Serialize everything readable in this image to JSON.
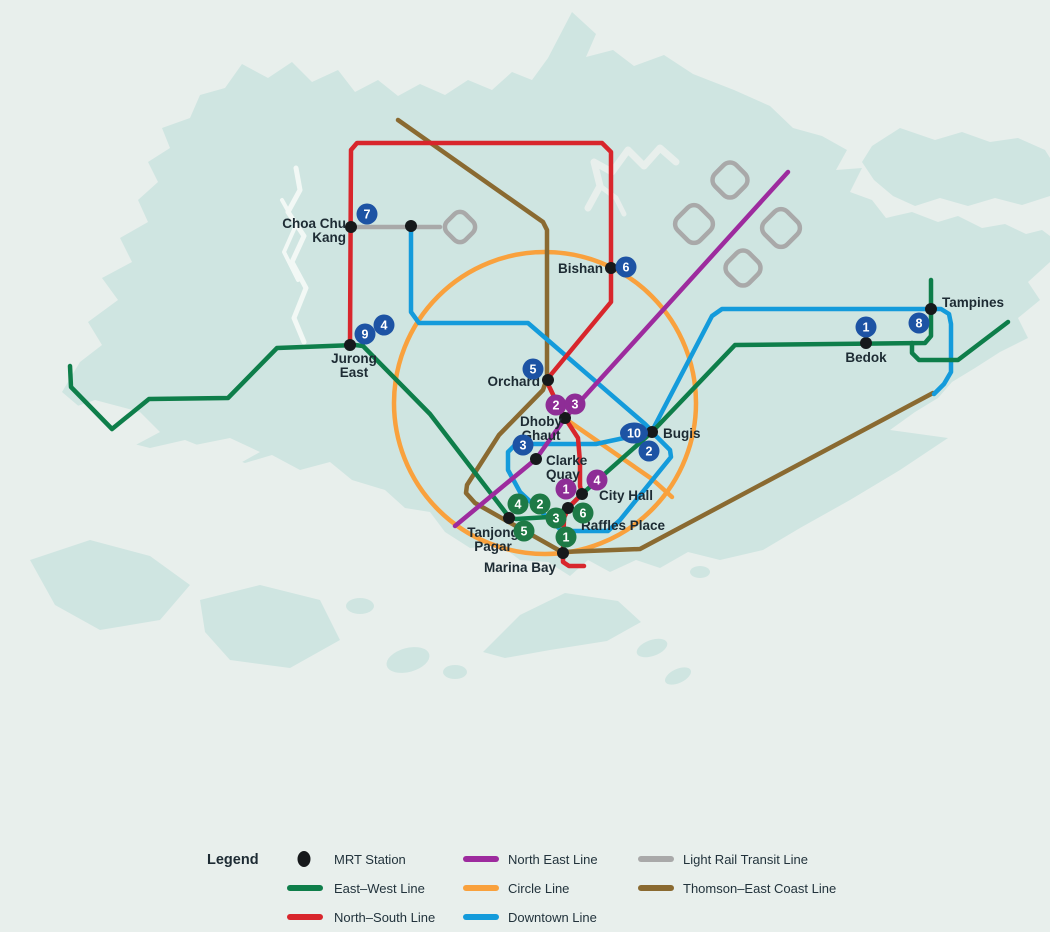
{
  "title": "Singapore MRT map",
  "colors": {
    "sea": "#e8efec",
    "island": "#cfe5e1",
    "island_soft": "#d8eae6",
    "water_detail": "#f2f8f5",
    "east_west": "#0e7e4a",
    "north_south": "#d8262c",
    "north_east": "#9d2b9e",
    "circle": "#f9a13d",
    "downtown": "#149bdb",
    "lrt": "#a9a9a9",
    "thomson": "#8a6a31",
    "badge_blue": "#1d53a4",
    "badge_purple": "#8e2d96",
    "badge_green": "#1e7a46",
    "station_dot": "#16191b",
    "label": "#1d2b33"
  },
  "stations": {
    "choa_chu_kang": {
      "line1": "Choa Chu",
      "line2": "Kang"
    },
    "bishan": {
      "label": "Bishan"
    },
    "jurong_east": {
      "line1": "Jurong",
      "line2": "East"
    },
    "orchard": {
      "label": "Orchard"
    },
    "dhoby_ghaut": {
      "line1": "Dhoby",
      "line2": "Ghaut"
    },
    "clarke_quay": {
      "line1": "Clarke",
      "line2": "Quay"
    },
    "bugis": {
      "label": "Bugis"
    },
    "city_hall": {
      "label": "City Hall"
    },
    "raffles_place": {
      "label": "Raffles Place"
    },
    "tanjong_pagar": {
      "line1": "Tanjong",
      "line2": "Pagar"
    },
    "marina_bay": {
      "label": "Marina Bay"
    },
    "bedok": {
      "label": "Bedok"
    },
    "tampines": {
      "label": "Tampines"
    }
  },
  "badges": {
    "blue": [
      "7",
      "6",
      "4",
      "9",
      "5",
      "3",
      "10",
      "2",
      "1",
      "8"
    ],
    "purple": [
      "2",
      "3",
      "4",
      "1"
    ],
    "green": [
      "4",
      "2",
      "6",
      "3",
      "5",
      "1"
    ]
  },
  "legend": {
    "title": "Legend",
    "mrt_station": "MRT Station",
    "east_west": "East–West Line",
    "north_south": "North–South Line",
    "north_east": "North East Line",
    "circle": "Circle Line",
    "downtown": "Downtown Line",
    "lrt": "Light Rail Transit Line",
    "thomson": "Thomson–East Coast Line"
  }
}
